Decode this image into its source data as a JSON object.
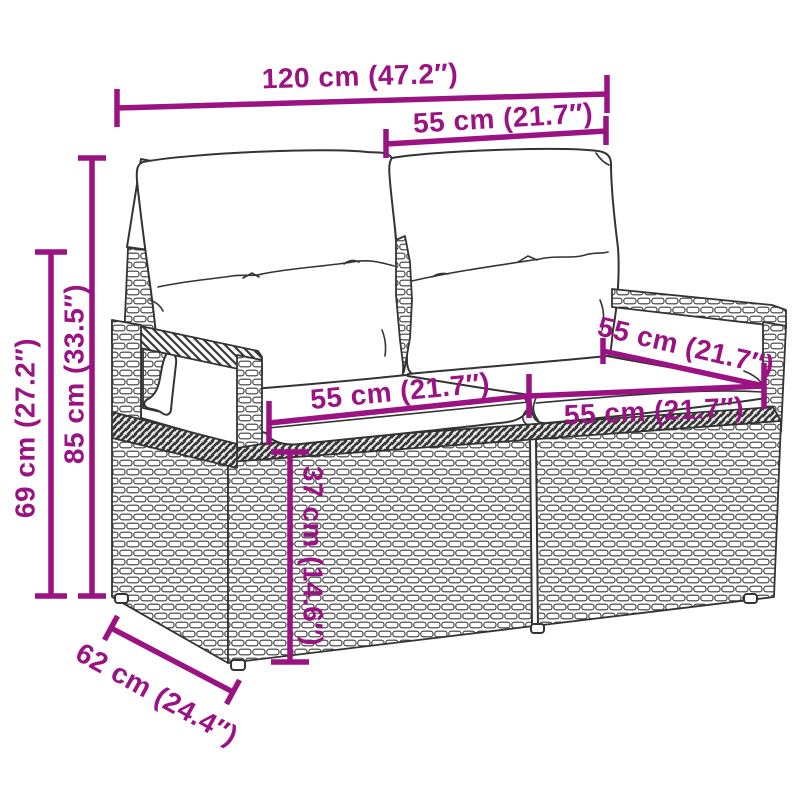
{
  "colors": {
    "dimension_accent": "#9B1283",
    "line_art": "#333333",
    "background": "#FFFFFF",
    "cushion_fill": "#FFFFFF"
  },
  "illustration": {
    "subject": "rattan-two-seater-garden-sofa-with-cushions"
  },
  "dimensions": [
    {
      "id": "overall-width",
      "label": "120 cm (47.2″)"
    },
    {
      "id": "backrest-width",
      "label": "55 cm (21.7″)"
    },
    {
      "id": "total-height",
      "label": "85 cm (33.5″)"
    },
    {
      "id": "armrest-height",
      "label": "69 cm (27.2″)"
    },
    {
      "id": "seat-width-left",
      "label": "55 cm (21.7″)"
    },
    {
      "id": "seat-width-right",
      "label": "55 cm (21.7″)"
    },
    {
      "id": "seat-depth",
      "label": "55 cm (21.7″)"
    },
    {
      "id": "seat-height",
      "label": "37 cm (14.6″)"
    },
    {
      "id": "base-depth",
      "label": "62 cm (24.4″)"
    }
  ]
}
